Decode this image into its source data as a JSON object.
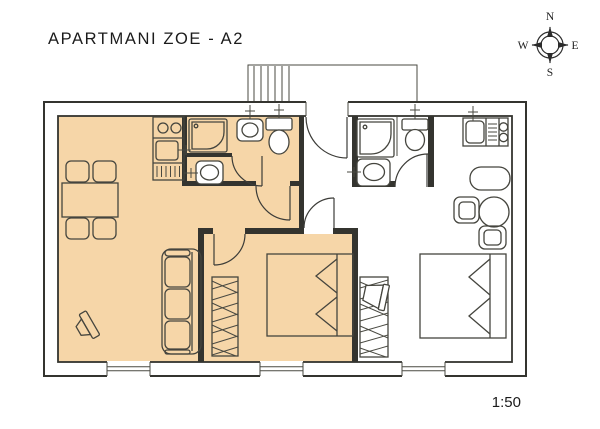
{
  "title": "APARTMANI ZOE - A2",
  "scale_label": "1:50",
  "compass": {
    "north_label": "N",
    "east_label": "E",
    "south_label": "S",
    "west_label": "W"
  },
  "colors": {
    "highlight": "#F6D6A8",
    "line": "#34342F",
    "background": "#FFFFFF",
    "fixture": "#FFFFFF"
  }
}
